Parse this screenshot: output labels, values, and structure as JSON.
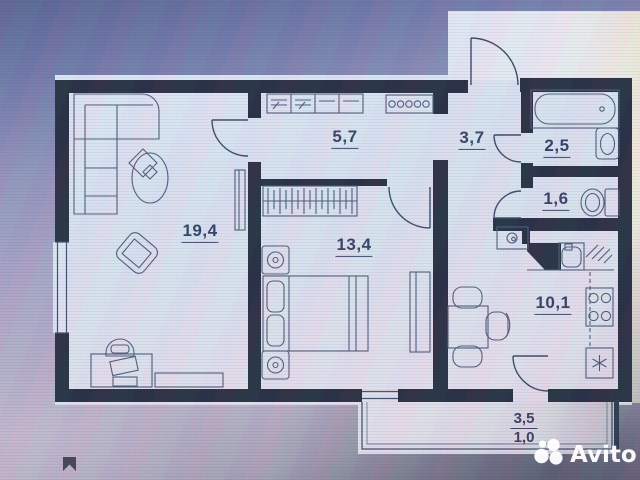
{
  "photo": {
    "description": "Photo of a computer screen showing an apartment floor plan from a real-estate listing"
  },
  "floor_plan": {
    "rooms": [
      {
        "name": "living-room",
        "area": "19,4"
      },
      {
        "name": "hallway",
        "area": "5,7"
      },
      {
        "name": "entrance-hall",
        "area": "3,7"
      },
      {
        "name": "bathroom",
        "area": "2,5"
      },
      {
        "name": "toilet",
        "area": "1,6"
      },
      {
        "name": "bedroom",
        "area": "13,4"
      },
      {
        "name": "kitchen",
        "area": "10,1"
      }
    ],
    "balcony": {
      "area_total": "3,5",
      "area_reduced": "1,0"
    },
    "fixture_icons": [
      "corner-sofa-icon",
      "coffee-table-icon",
      "armchair-icon",
      "desk-icon",
      "desk-chair-icon",
      "tv-stand-icon",
      "tall-cabinet-icon",
      "hall-wardrobe-icon",
      "coat-hooks-icon",
      "clothes-rail-icon",
      "double-bed-icon",
      "nightstand-icon",
      "bedroom-wardrobe-icon",
      "kitchen-vent-icon",
      "kitchen-sink-icon",
      "dish-drainer-icon",
      "stove-icon",
      "washing-machine-icon",
      "dining-table-icon",
      "dining-chair-icon",
      "bathtub-icon",
      "washbasin-icon",
      "toilet-icon"
    ]
  },
  "watermark": {
    "brand": "Avito"
  },
  "colors": {
    "wall": "#212838",
    "furniture_line": "#4a5773",
    "label": "#2e3a5c",
    "sheet": "#e3e8f4",
    "watermark": "#ffffff"
  }
}
